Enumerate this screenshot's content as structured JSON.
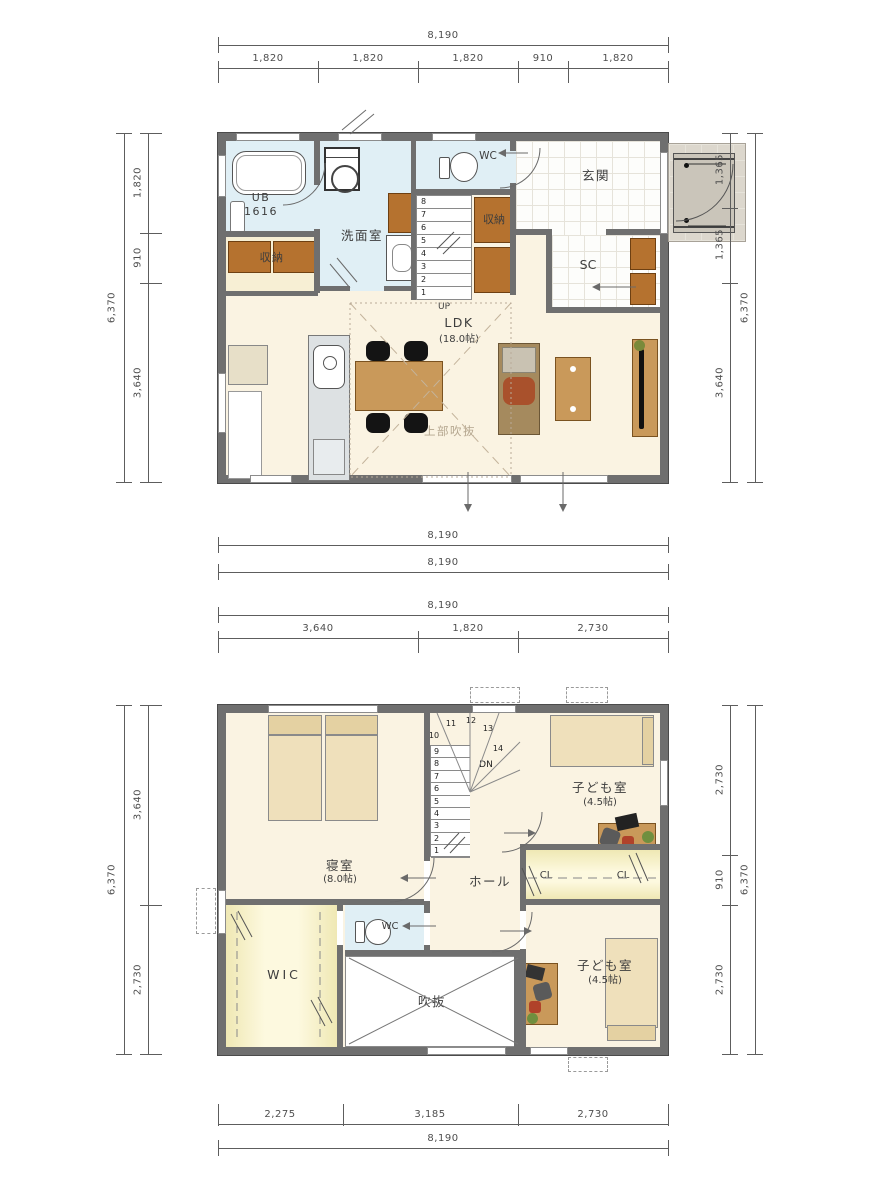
{
  "colors": {
    "wall": "#6f6f6f",
    "floor_cream": "#faf3e2",
    "floor_wet_blue": "#e0eff5",
    "floor_closet_yellow": "#f5eec2",
    "cabinet_brown": "#b5722f",
    "furniture_beige": "#efe0bb",
    "table_tan": "#c9995a",
    "dim_text": "#4e4e4e"
  },
  "floor1": {
    "dim_top_total": "8,190",
    "dim_top_segments": [
      "1,820",
      "1,820",
      "1,820",
      "910",
      "1,820"
    ],
    "dim_left_total": "6,370",
    "dim_left_segments": [
      "1,820",
      "910",
      "3,640"
    ],
    "dim_right_total": "6,370",
    "dim_right_segments": [
      "1,365",
      "1,365",
      "3,640"
    ],
    "dim_bottom_outer": "8,190",
    "dim_bottom_inner": "8,190",
    "labels": {
      "ub": "UB",
      "ub_size": "1616",
      "senmenshitsu": "洗面室",
      "wc": "WC",
      "shunou_left": "収納",
      "shunou_right": "収納",
      "genkan": "玄関",
      "sc": "SC",
      "ldk": "LDK",
      "ldk_size": "(18.0帖)",
      "joubu_fukinuke": "上部吹抜",
      "up": "UP"
    },
    "stair_numbers": [
      "8",
      "7",
      "6",
      "5",
      "4",
      "3",
      "2",
      "1"
    ]
  },
  "floor2": {
    "dim_top_total": "8,190",
    "dim_top_segments": [
      "3,640",
      "1,820",
      "2,730"
    ],
    "dim_left_total": "6,370",
    "dim_left_segments": [
      "3,640",
      "2,730"
    ],
    "dim_right_total": "6,370",
    "dim_right_segments": [
      "2,730",
      "910",
      "2,730"
    ],
    "dim_bottom_total": "8,190",
    "dim_bottom_segments": [
      "2,275",
      "3,185",
      "2,730"
    ],
    "labels": {
      "shinshitsu": "寝室",
      "shinshitsu_size": "(8.0帖)",
      "kodomo_top": "子ども室",
      "kodomo_top_size": "(4.5帖)",
      "kodomo_bottom": "子ども室",
      "kodomo_bottom_size": "(4.5帖)",
      "hall": "ホール",
      "wic": "WIC",
      "wc": "WC",
      "fukinuke": "吹抜",
      "cl_left": "CL",
      "cl_right": "CL",
      "dn": "DN"
    },
    "stair_numbers_straight": [
      "9",
      "8",
      "7",
      "6",
      "5",
      "4",
      "3",
      "2",
      "1"
    ],
    "stair_numbers_winder": [
      "10",
      "11",
      "12",
      "13",
      "14"
    ]
  }
}
